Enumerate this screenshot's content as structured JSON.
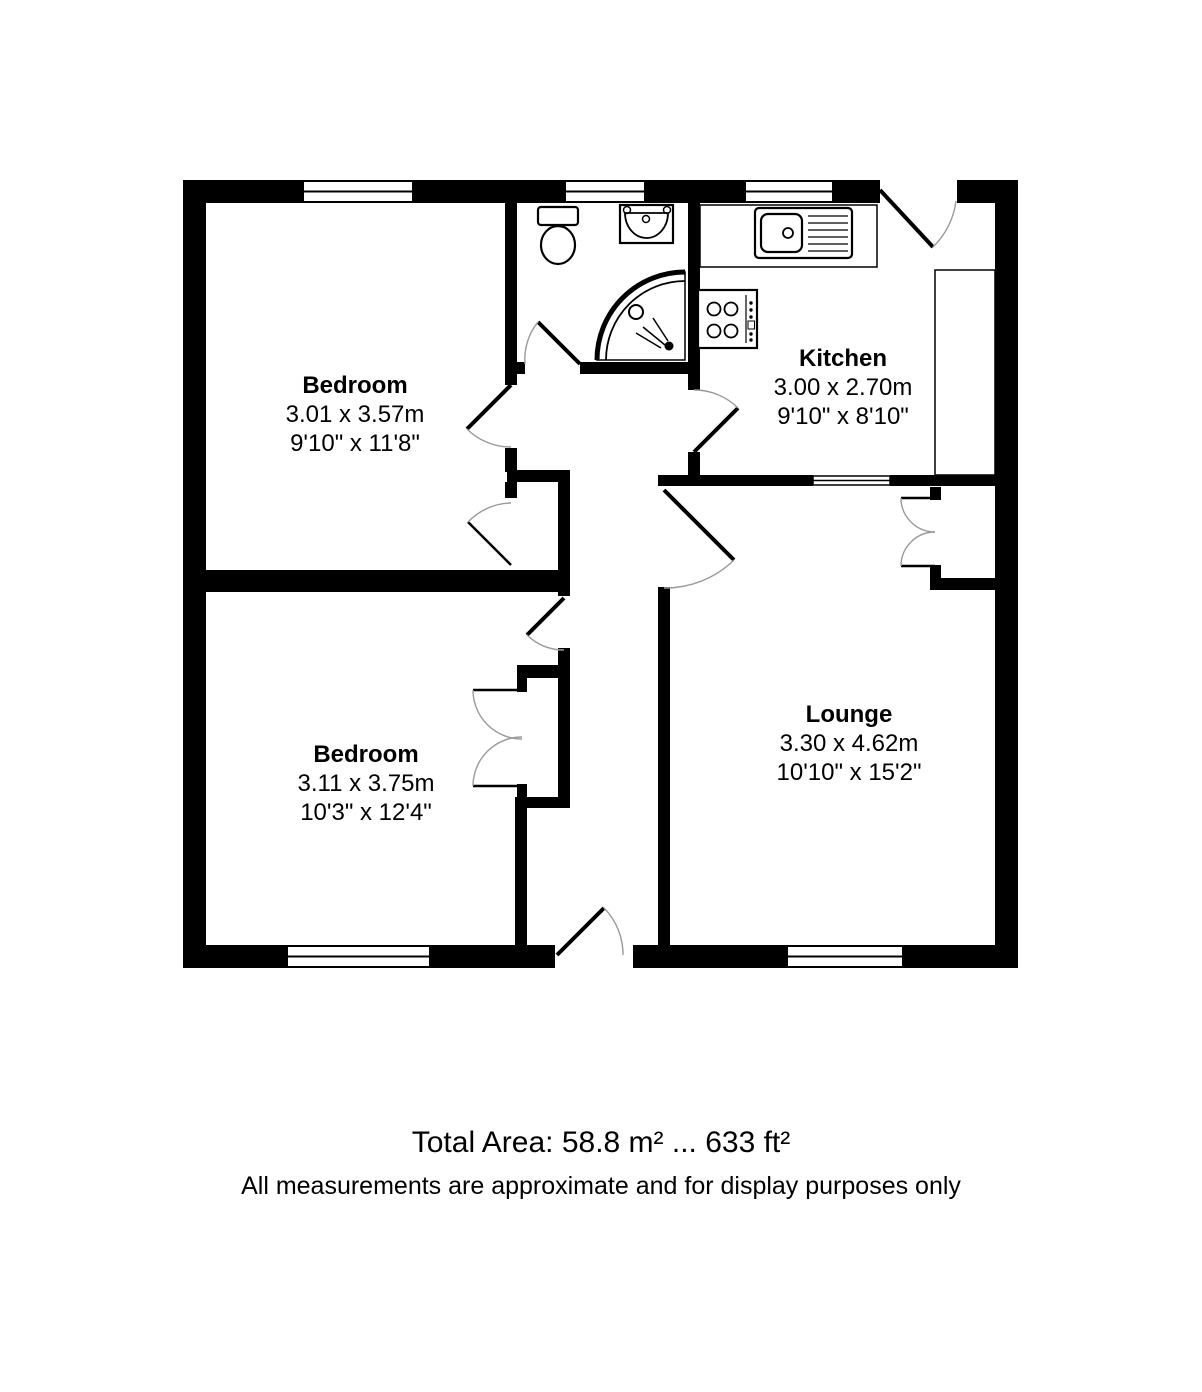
{
  "floorplan": {
    "rooms": [
      {
        "id": "bedroom-1",
        "name": "Bedroom",
        "metric": "3.01 x 3.57m",
        "imperial": "9'10\" x 11'8\""
      },
      {
        "id": "kitchen",
        "name": "Kitchen",
        "metric": "3.00 x 2.70m",
        "imperial": "9'10\" x 8'10\""
      },
      {
        "id": "lounge",
        "name": "Lounge",
        "metric": "3.30 x 4.62m",
        "imperial": "10'10\" x 15'2\""
      },
      {
        "id": "bedroom-2",
        "name": "Bedroom",
        "metric": "3.11 x 3.75m",
        "imperial": "10'3\" x 12'4\""
      }
    ],
    "footer": {
      "total_area": "Total Area: 58.8 m² ... 633 ft²",
      "disclaimer": "All measurements are approximate and for display purposes only"
    },
    "colors": {
      "wall": "#000000",
      "background": "#ffffff",
      "door_arc": "#9a9a9a"
    },
    "icons": [
      "toilet-icon",
      "basin-icon",
      "corner-shower-icon",
      "sink-drainer-icon",
      "hob-icon",
      "worktop-icon",
      "window-icon",
      "door-icon",
      "wardrobe-double-doors-icon"
    ]
  }
}
